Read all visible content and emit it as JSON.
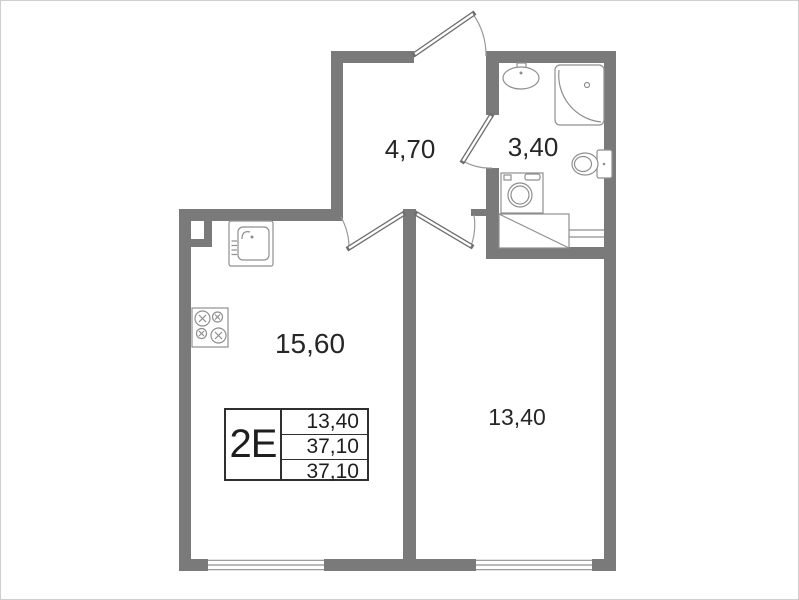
{
  "floorplan": {
    "unit_code": "2E",
    "rooms": {
      "hallway": {
        "area": "4,70"
      },
      "bathroom": {
        "area": "3,40"
      },
      "kitchen_living": {
        "area": "15,60"
      },
      "bedroom": {
        "area": "13,40"
      }
    },
    "info_table": {
      "code": "2E",
      "rows": [
        "13,40",
        "37,10",
        "37,10"
      ]
    },
    "colors": {
      "wall": "#7a7a7a",
      "fixture_line": "#8f8f8f",
      "label_text": "#262626"
    }
  }
}
